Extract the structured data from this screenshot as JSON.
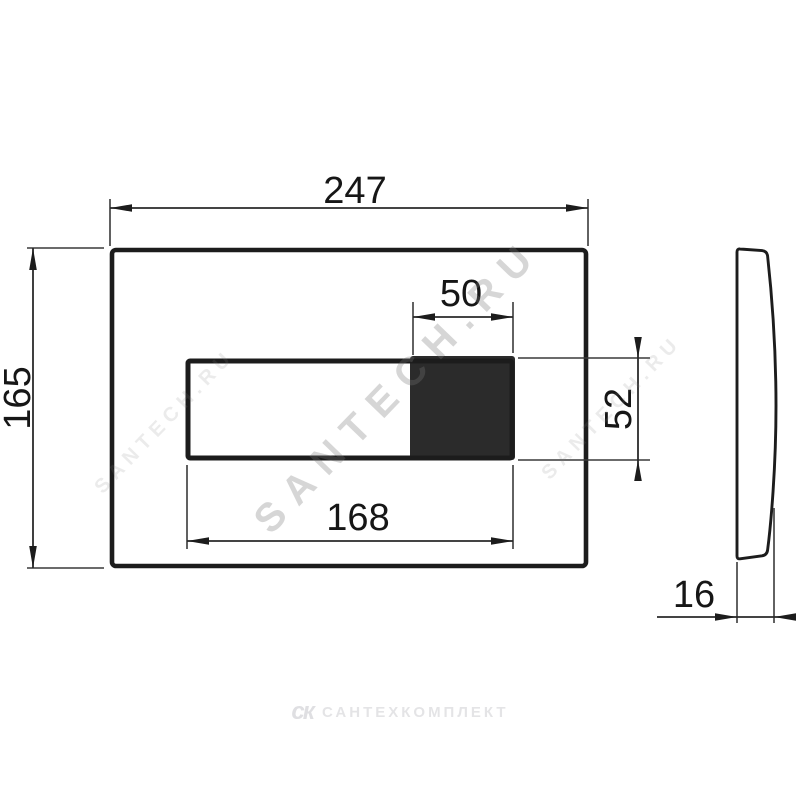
{
  "dims": {
    "plate_width": "247",
    "plate_height": "165",
    "button_width": "50",
    "button_height": "52",
    "panel_width": "168",
    "thickness": "16"
  },
  "watermarks": {
    "diagonal": "SANTECH.RU",
    "tile": "SANTECH.RU",
    "footer_logo": "ск",
    "footer_text": "САНТЕХКОМПЛЕКТ"
  },
  "colors": {
    "background": "#ffffff",
    "outline": "#1c1c1c",
    "dimension_line": "#2a2a2a",
    "button_fill": "#2b2b2b",
    "watermark": "#bdbdbd"
  }
}
